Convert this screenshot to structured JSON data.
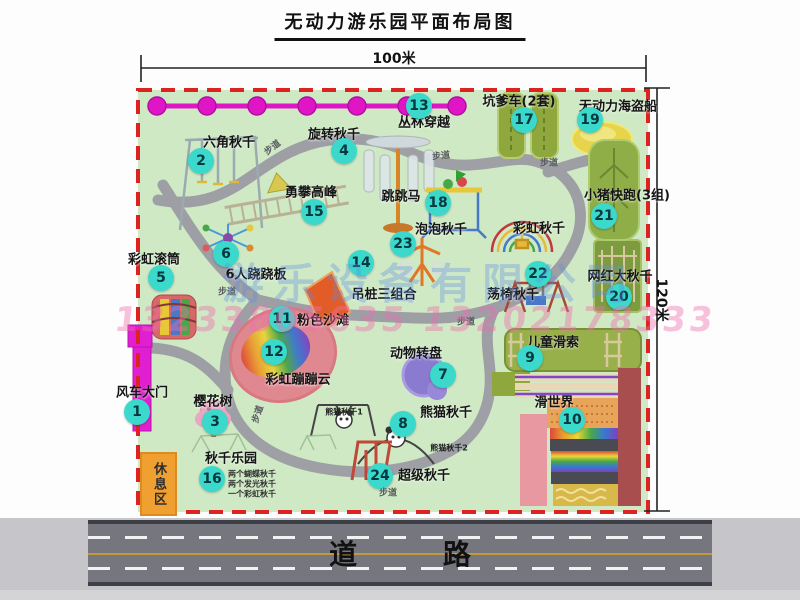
{
  "title": "无动力游乐园平面布局图",
  "dimensions": {
    "width_label": "100米",
    "height_label": "120米"
  },
  "road": {
    "label": "道  路"
  },
  "rest_area_label": "休息区",
  "watermark": {
    "company": "游乐设备有限公司",
    "phones": "13233805635 13202178333"
  },
  "map": {
    "attractions": [
      {
        "num": "1",
        "name": "风车大门",
        "lx": 142,
        "ly": 391,
        "bx": 137,
        "by": 412
      },
      {
        "num": "2",
        "name": "六角秋千",
        "lx": 229,
        "ly": 141,
        "bx": 201,
        "by": 161
      },
      {
        "num": "3",
        "name": "樱花树",
        "lx": 213,
        "ly": 400,
        "bx": 215,
        "by": 422
      },
      {
        "num": "4",
        "name": "旋转秋千",
        "lx": 334,
        "ly": 133,
        "bx": 344,
        "by": 151
      },
      {
        "num": "5",
        "name": "彩虹滚筒",
        "lx": 154,
        "ly": 258,
        "bx": 161,
        "by": 278
      },
      {
        "num": "6",
        "name": "6人跷跷板",
        "lx": 256,
        "ly": 273,
        "bx": 226,
        "by": 254
      },
      {
        "num": "7",
        "name": "动物转盘",
        "lx": 416,
        "ly": 352,
        "bx": 443,
        "by": 375
      },
      {
        "num": "8",
        "name": "熊猫秋千",
        "lx": 446,
        "ly": 411,
        "bx": 403,
        "by": 424
      },
      {
        "num": "9",
        "name": "儿童滑索",
        "lx": 553,
        "ly": 341,
        "bx": 530,
        "by": 358
      },
      {
        "num": "10",
        "name": "滑世界",
        "lx": 554,
        "ly": 401,
        "bx": 572,
        "by": 420
      },
      {
        "num": "11",
        "name": "粉色沙滩",
        "lx": 323,
        "ly": 319,
        "bx": 282,
        "by": 319
      },
      {
        "num": "12",
        "name": "彩虹蹦蹦云",
        "lx": 298,
        "ly": 378,
        "bx": 274,
        "by": 352
      },
      {
        "num": "13",
        "name": "丛林穿越",
        "lx": 424,
        "ly": 121,
        "bx": 419,
        "by": 106
      },
      {
        "num": "14",
        "name": "吊桩三组合",
        "lx": 384,
        "ly": 293,
        "bx": 361,
        "by": 263
      },
      {
        "num": "15",
        "name": "勇攀高峰",
        "lx": 311,
        "ly": 191,
        "bx": 314,
        "by": 212
      },
      {
        "num": "16",
        "name": "秋千乐园",
        "lx": 231,
        "ly": 457,
        "bx": 212,
        "by": 479,
        "sub": [
          "两个蝴蝶秋千",
          "两个发光秋千",
          "一个彩虹秋千"
        ],
        "subx": 228,
        "suby": 474
      },
      {
        "num": "17",
        "name": "坑爹车(2套)",
        "lx": 519,
        "ly": 100,
        "bx": 524,
        "by": 120
      },
      {
        "num": "18",
        "name": "跳跳马",
        "lx": 401,
        "ly": 195,
        "bx": 438,
        "by": 203
      },
      {
        "num": "19",
        "name": "无动力海盗船",
        "lx": 618,
        "ly": 105,
        "bx": 590,
        "by": 120
      },
      {
        "num": "20",
        "name": "网红大秋千",
        "lx": 620,
        "ly": 275,
        "bx": 619,
        "by": 297
      },
      {
        "num": "21",
        "name": "小猪快跑(3组)",
        "lx": 627,
        "ly": 194,
        "bx": 604,
        "by": 216
      },
      {
        "num": "22",
        "name": "荡椅秋千",
        "lx": 513,
        "ly": 293,
        "bx": 538,
        "by": 274
      },
      {
        "num": "23",
        "name": "泡泡秋千",
        "lx": 441,
        "ly": 228,
        "bx": 403,
        "by": 244
      },
      {
        "num": "24",
        "name": "超级秋千",
        "lx": 424,
        "ly": 474,
        "bx": 380,
        "by": 476
      }
    ],
    "extra_labels": [
      {
        "text": "彩虹秋千",
        "x": 539,
        "y": 227,
        "size": 13
      },
      {
        "text": "熊猫秋千1",
        "x": 344,
        "y": 412,
        "size": 8
      },
      {
        "text": "熊猫秋千2",
        "x": 449,
        "y": 448,
        "size": 8
      }
    ],
    "path_labels": [
      {
        "text": "步道",
        "x": 272,
        "y": 147,
        "rot": -38
      },
      {
        "text": "步道",
        "x": 441,
        "y": 155,
        "rot": -6
      },
      {
        "text": "步道",
        "x": 549,
        "y": 162,
        "rot": 0
      },
      {
        "text": "步道",
        "x": 227,
        "y": 291,
        "rot": 0
      },
      {
        "text": "步道",
        "x": 466,
        "y": 321,
        "rot": 0
      },
      {
        "text": "步道",
        "x": 388,
        "y": 492,
        "rot": 0
      },
      {
        "text": "步道",
        "x": 257,
        "y": 414,
        "rot": -72
      }
    ]
  },
  "colors": {
    "map_green": "#cfe9c5",
    "border_red": "#dd2222",
    "badge_teal": "#3bd9cb",
    "magenta": "#e016c6",
    "path_gray": "#9b9ca4",
    "rest_orange": "#f0a030",
    "road_gray": "#76767e"
  }
}
